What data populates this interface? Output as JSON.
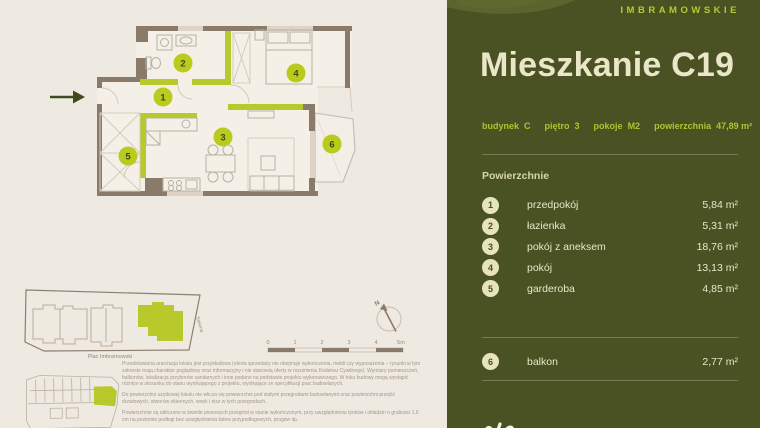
{
  "brand": {
    "name": "IMBRAMOWSKIE"
  },
  "header": {
    "title": "Mieszkanie C19"
  },
  "meta": {
    "items": [
      {
        "label": "budynek",
        "value": "C"
      },
      {
        "label": "piętro",
        "value": "3"
      },
      {
        "label": "pokoje",
        "value": "M2"
      },
      {
        "label": "powierzchnia",
        "value": "47,89 m²"
      }
    ]
  },
  "areas": {
    "section_label": "Powierzchnie",
    "rooms": [
      {
        "no": "1",
        "name": "przedpokój",
        "area": "5,84 m²"
      },
      {
        "no": "2",
        "name": "łazienka",
        "area": "5,31 m²"
      },
      {
        "no": "3",
        "name": "pokój z aneksem",
        "area": "18,76 m²"
      },
      {
        "no": "4",
        "name": "pokój",
        "area": "13,13 m²"
      },
      {
        "no": "5",
        "name": "garderoba",
        "area": "4,85 m²"
      }
    ],
    "extra": [
      {
        "no": "6",
        "name": "balkon",
        "area": "2,77 m²"
      }
    ]
  },
  "plan": {
    "markers": [
      {
        "no": "1"
      },
      {
        "no": "2"
      },
      {
        "no": "3"
      },
      {
        "no": "4"
      },
      {
        "no": "5"
      },
      {
        "no": "6"
      }
    ],
    "compass_label": "N",
    "scale": {
      "ticks": [
        "0",
        "1",
        "2",
        "3",
        "4",
        "5m"
      ]
    }
  },
  "site": {
    "square_label": "Plac Imbramowski",
    "street_label": "Siewna"
  },
  "disclaimer": {
    "paragraphs": [
      "Przedstawiona aranżacja lokalu jest przykładowa (oferta sprzedaży nie obejmuje wykończenia, mebli czy wyposażenia – rysunki w tym zakresie mają charakter poglądowy oraz informacyjny i nie stanowią oferty w rozumieniu Kodeksu Cywilnego). Wymiary pomieszczeń, balkonów, lokalizacja przyborów sanitarnych i inne podano na podstawie projektu wykonawczego. W toku budowy mogą wystąpić różnice w stosunku do stanu wynikającego z projektu, wynikające ze specyfikacji prac budowlanych.",
      "Do powierzchni użytkowej lokalu nie wlicza się powierzchni pod stałymi przegrodami budowlanymi oraz powierzchni przejść drzwiowych, otworów okiennych, wnęk i nisz w tych przegrodach.",
      "Powierzchnie są obliczone w świetle pionowych przegród w stanie wykończonym, przy uwzględnieniu tynków i okładzin o grubości 1,5 cm na poziomie podłogi bez uwzględnienia listew przypodłogowych, progów itp."
    ]
  },
  "colors": {
    "accent_lime": "#B7C92B",
    "panel_background": "#4A5223",
    "panel_text_cream": "#EAE7C9",
    "wall_brown": "#8A7A69",
    "page_background": "#EFEAE1"
  }
}
